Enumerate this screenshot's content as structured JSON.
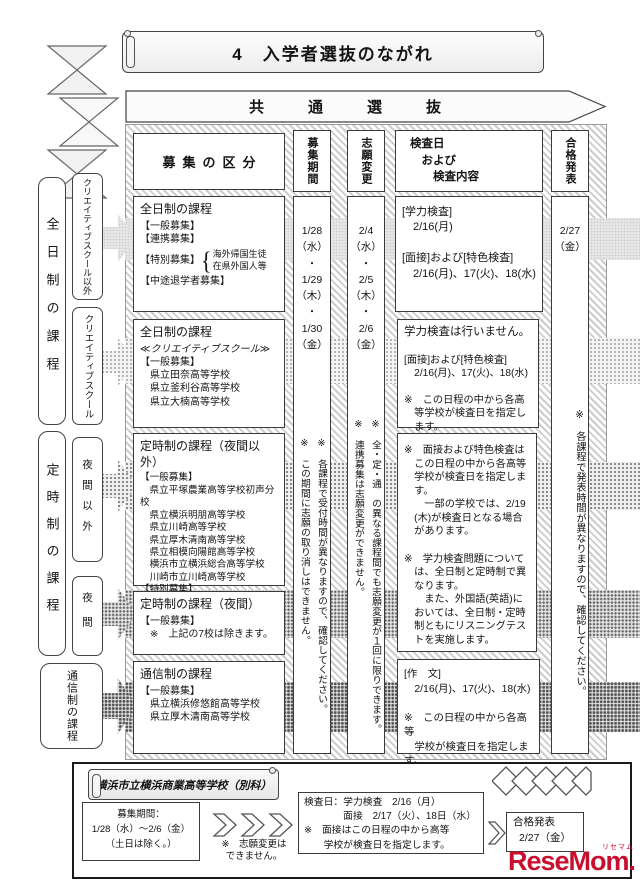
{
  "page": {
    "title": "4　入学者選抜のながれ",
    "common_banner": "共通選抜"
  },
  "columns": {
    "category": "募集の区分",
    "period": "募集期間",
    "change": "志願変更",
    "exam": [
      "検査日",
      "　および",
      "　　検査内容"
    ],
    "result": "合格発表"
  },
  "sidebar": {
    "fulltime": "全日制の課程",
    "creative_other": "クリエイティブスクール以外",
    "creative": "クリエイティブスクール",
    "parttime": "定時制の課程",
    "night_other": "夜間以外",
    "night": "夜間",
    "correspondence": "通信制の課程"
  },
  "category_boxes": {
    "fulltime_general": {
      "title": "全日制の課程",
      "items_top": [
        "【一般募集】",
        "【連携募集】"
      ],
      "special_label": "【特別募集】",
      "special_brace": "{",
      "special_items": [
        "海外帰国生徒",
        "在県外国人等"
      ],
      "items_bottom": [
        "【中途退学者募集】"
      ]
    },
    "creative": {
      "title": "全日制の課程",
      "subtitle": "≪クリエイティブスクール≫",
      "items": [
        "【一般募集】",
        "　県立田奈高等学校",
        "　県立釜利谷高等学校",
        "　県立大楠高等学校"
      ]
    },
    "parttime_day": {
      "title": "定時制の課程（夜間以外）",
      "items": [
        "【一般募集】",
        "　県立平塚農業高等学校初声分校",
        "　県立横浜明朋高等学校",
        "　県立川崎高等学校",
        "　県立厚木清南高等学校",
        "　県立相模向陽館高等学校",
        "　横浜市立横浜総合高等学校",
        "　川崎市立川崎高等学校",
        "【特別募集】",
        "　在県外国人等"
      ]
    },
    "parttime_night": {
      "title": "定時制の課程（夜間）",
      "items": [
        "【一般募集】",
        "　※　上記の7校は除きます。"
      ]
    },
    "correspondence": {
      "title": "通信制の課程",
      "items": [
        "【一般募集】",
        "　県立横浜修悠館高等学校",
        "　県立厚木清南高等学校"
      ]
    }
  },
  "period_column": {
    "dates": [
      "1/28",
      "（水）",
      "・",
      "1/29",
      "（木）",
      "・",
      "1/30",
      "（金）"
    ],
    "notes": [
      "※　各課程で受付時間が異なりますので、確認してください。",
      "※　この期間に志願の取り消しはできません。"
    ]
  },
  "change_column": {
    "dates": [
      "2/4",
      "（水）",
      "・",
      "2/5",
      "（木）",
      "・",
      "2/6",
      "（金）"
    ],
    "notes": [
      "※　全・定・通　の異なる課程間でも志願変更が１回に限りできます。",
      "※　連携募集は志願変更ができません。"
    ]
  },
  "result_column": {
    "date": [
      "2/27",
      "（金）"
    ],
    "note": "※　各課程で発表時間が異なりますので、確認してください。"
  },
  "exam_boxes": {
    "fulltime_general": [
      "[学力検査]",
      "　2/16(月)",
      "",
      "[面接]および[特色検査]",
      "　2/16(月)、17(火)、18(水)"
    ],
    "creative_title": "学力検査は行いません。",
    "creative": [
      "",
      "[面接]および[特色検査]",
      "　2/16(月)、17(火)、18(水)",
      "",
      "※　この日程の中から各高",
      "　等学校が検査日を指定し",
      "　ます。"
    ],
    "notes": [
      "※　面接および特色検査は",
      "　この日程の中から各高等",
      "　学校が検査日を指定しま",
      "　す。",
      "　　一部の学校では、2/19",
      "　(木)が検査日となる場合",
      "　があります。",
      "",
      "※　学力検査問題について",
      "　は、全日制と定時制で異",
      "　なります。",
      "　　また、外国語(英語)に",
      "　おいては、全日制・定時",
      "　制ともにリスニングテス",
      "　トを実施します。"
    ],
    "correspondence": [
      "[作　文]",
      "　2/16(月)、17(火)、18(水)",
      "",
      "※　この日程の中から各高等",
      "　学校が検査日を指定します。"
    ]
  },
  "bottom": {
    "title": "横浜市立横浜商業高等学校（別科）",
    "recruit": [
      "募集期間：",
      "1/28（水）～2/6（金）",
      "（土日は除く。）"
    ],
    "chevron_note": [
      "※　志願変更は",
      "できません。"
    ],
    "exam": [
      "検査日：学力検査　2/16（月）",
      "　　　　面接　2/17（火）、18日（水）",
      "※　面接はこの日程の中から高等",
      "　　学校が検査日を指定します。"
    ],
    "result_title": "合格発表",
    "result_date": "2/27（金）"
  },
  "watermark": {
    "text": "ReseMom",
    "dot": ".",
    "ruby": "リセマム"
  }
}
